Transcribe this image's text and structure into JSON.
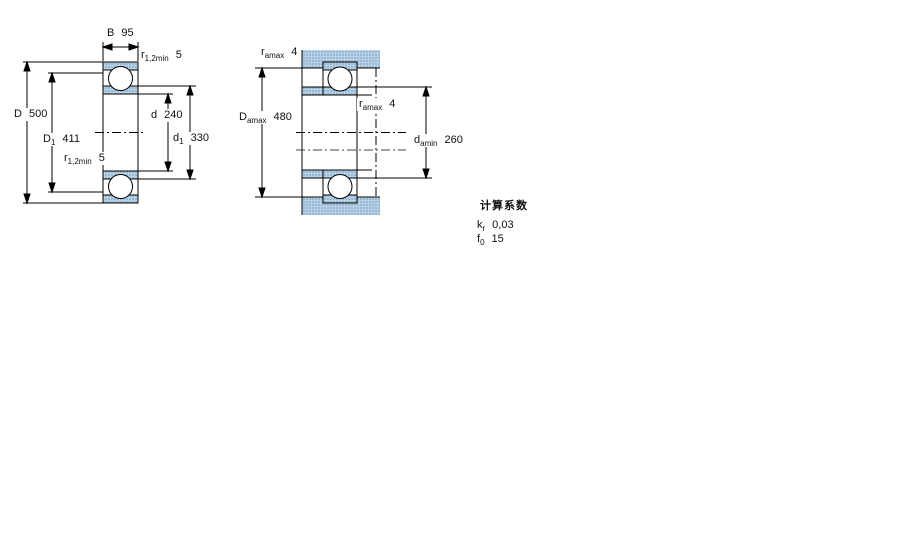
{
  "page": {
    "kind": "bearing-dimension-drawing",
    "background": "#ffffff"
  },
  "colors": {
    "line": "#000000",
    "hatch_blue_base": "#b9d3e8",
    "hatch_blue_dot": "#7fa3c4",
    "text": "#111111"
  },
  "drawing1": {
    "name": "bearing-cross-section",
    "labels": {
      "B": {
        "sym": "B",
        "sub": "",
        "value": "95"
      },
      "r_top": {
        "sym": "r",
        "sub": "1,2min",
        "value": "5"
      },
      "D": {
        "sym": "D",
        "sub": "",
        "value": "500"
      },
      "D1": {
        "sym": "D",
        "sub": "1",
        "value": "411"
      },
      "r_bot": {
        "sym": "r",
        "sub": "1,2min",
        "value": "5"
      },
      "d": {
        "sym": "d",
        "sub": "",
        "value": "240"
      },
      "d1": {
        "sym": "d",
        "sub": "1",
        "value": "330"
      }
    }
  },
  "drawing2": {
    "name": "bearing-mounting-dimensions",
    "labels": {
      "r_amax_top": {
        "sym": "r",
        "sub": "amax",
        "value": "4"
      },
      "Damax": {
        "sym": "D",
        "sub": "amax",
        "value": "480"
      },
      "r_amax_mid": {
        "sym": "r",
        "sub": "amax",
        "value": "4"
      },
      "damin": {
        "sym": "d",
        "sub": "amin",
        "value": "260"
      }
    }
  },
  "factors": {
    "heading": "计算系数",
    "kr": {
      "sym": "k",
      "sub": "r",
      "value": "0,03"
    },
    "f0": {
      "sym": "f",
      "sub": "0",
      "value": "15"
    }
  }
}
